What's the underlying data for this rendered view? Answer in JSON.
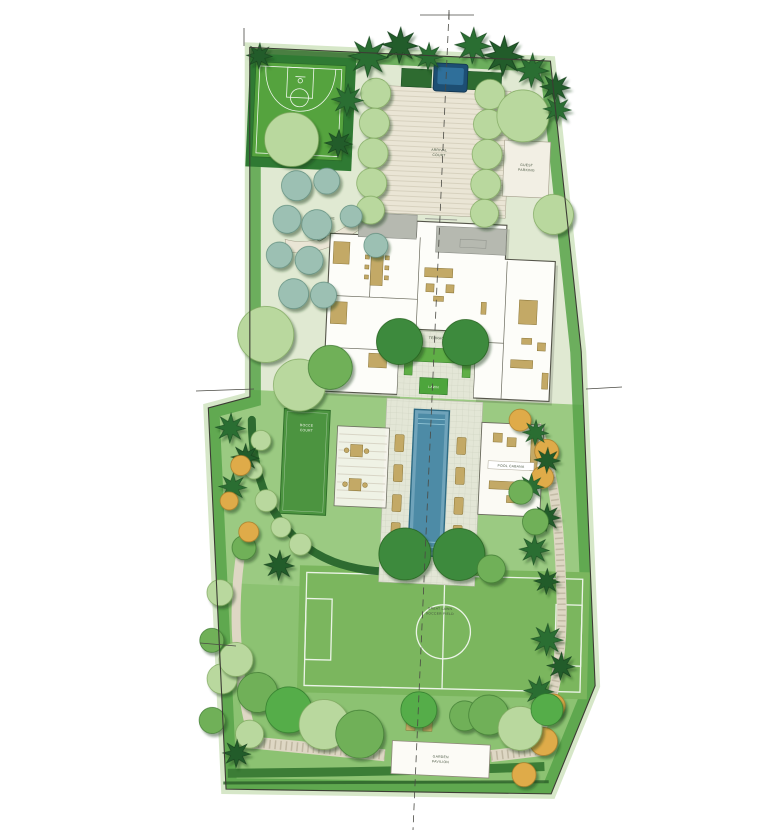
{
  "plan": {
    "type": "residential landscape master plan",
    "labels": {
      "sport1": "SPORT",
      "sport2": "COURT",
      "drive": "GRAVEL DRIVE",
      "arrival1": "ARRIVAL",
      "arrival2": "COURT",
      "guest1": "GUEST",
      "guest2": "PARKING",
      "terrace": "TERRACE",
      "lawn_panel": "LAWN",
      "bocce1": "BOCCE",
      "bocce2": "COURT",
      "cabana": "POOL CABANA",
      "field1": "GREAT LAWN",
      "field2": "SOCCER FIELD",
      "pav1": "GARDEN",
      "pav2": "PAVILION"
    }
  },
  "colors": {
    "boundary": "#3c3c34",
    "halo": "#d6e7c8",
    "lawnUpper": "#e0e9d2",
    "lawnMid": "#9bca82",
    "lawnLower": "#8cc272",
    "band": "#57a349",
    "court": "#55a33e",
    "courtBed": "#2f7a33",
    "gravel": "#eae5d5",
    "paving": "#e3e6d6",
    "pool": "#6fa3ba",
    "poolDark": "#4d8ba6",
    "water": "#1d4e73",
    "house": "#fdfdf9",
    "roof": "#b6b9b0",
    "furniture": "#c3a966",
    "hedge": "#2e6b30",
    "field": "#7bb65e",
    "path": "#ded7c4",
    "treeLight": "#b9d89e",
    "treeMid": "#6fb058",
    "treeBright": "#54ad49",
    "treeDark": "#3d8a3c",
    "teal": "#9cc0b3",
    "orange": "#dfab48",
    "conifer": "#2c6e33",
    "coniferDark": "#245c2b",
    "label": "#44523d"
  }
}
